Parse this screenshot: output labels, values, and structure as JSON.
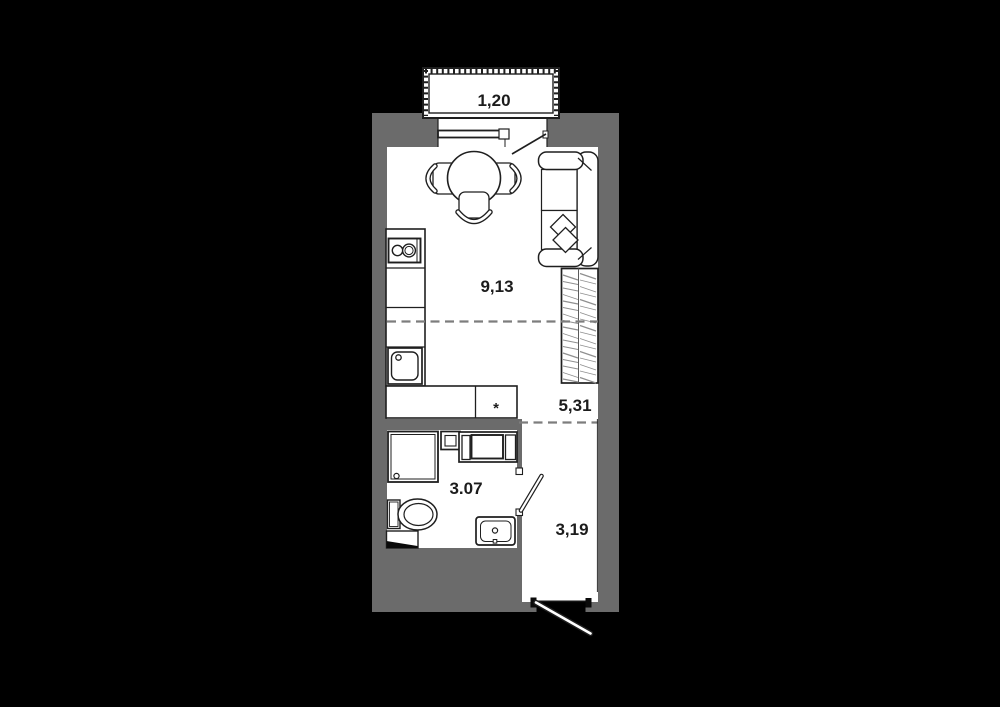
{
  "plan": {
    "kind": "studio-apartment-floor-plan",
    "colors": {
      "background": "#000000",
      "wall": "#6b6b6b",
      "floor": "#ffffff",
      "outline": "#1f1f1f",
      "hatch": "#8f8f8f",
      "zone_dash": "#7d7d7d"
    },
    "rooms": {
      "balcony": {
        "name": "balcony",
        "area": "1,20"
      },
      "living_kitchen": {
        "name": "living-kitchen",
        "area": "9,13"
      },
      "corridor": {
        "name": "corridor",
        "area": "5,31"
      },
      "bathroom": {
        "name": "bathroom",
        "area": "3.07"
      },
      "hallway": {
        "name": "entrance-hallway",
        "area": "3,19"
      }
    },
    "markers": {
      "appliance_asterisk": "*"
    },
    "furniture_icons": [
      "dining-table-icon",
      "chair-icon",
      "sofa-icon",
      "pillow-icon",
      "wardrobe-icon",
      "kitchen-counter-icon",
      "stove-icon",
      "kitchen-sink-icon",
      "shower-icon",
      "toilet-icon",
      "water-heater-icon",
      "washer-unit-icon",
      "bathroom-sink-icon",
      "window-icon",
      "balcony-door-icon",
      "bathroom-door-icon",
      "entrance-door-icon"
    ]
  }
}
